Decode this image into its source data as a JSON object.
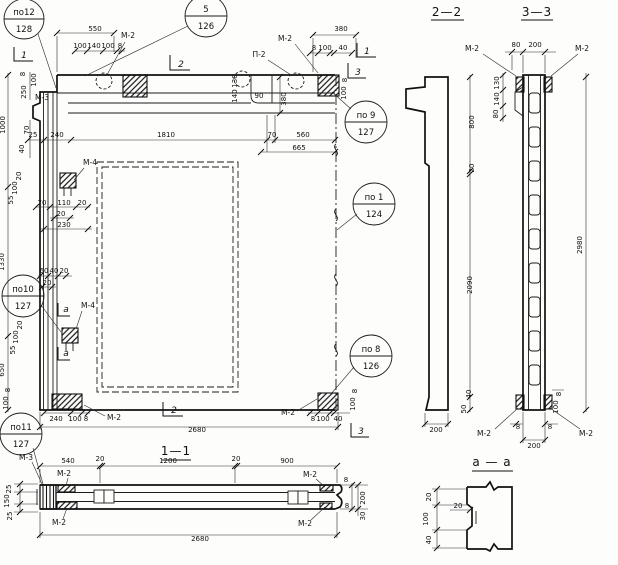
{
  "marks": {
    "m2": "М-2",
    "m3": "М-3",
    "m4": "М-4",
    "p2": "П-2"
  },
  "flags": {
    "s1": "1",
    "s2": "2",
    "s3": "3",
    "sa": "а"
  },
  "front": {
    "callouts": {
      "po12": {
        "pos": "по12",
        "sheet": "128"
      },
      "k5": {
        "pos": "5",
        "sheet": "126"
      },
      "po9": {
        "pos": "по 9",
        "sheet": "127"
      },
      "po1": {
        "pos": "по 1",
        "sheet": "124"
      },
      "po10": {
        "pos": "по10",
        "sheet": "127"
      },
      "po8": {
        "pos": "по 8",
        "sheet": "126"
      },
      "po11": {
        "pos": "по11",
        "sheet": "127"
      }
    },
    "dims": {
      "top": {
        "d550": "550",
        "sub": [
          "100",
          "140",
          "100",
          "8"
        ],
        "d380": "380",
        "sub_r": [
          "8",
          "100",
          "40"
        ]
      },
      "inner": {
        "chain": [
          "25",
          "240",
          "1810",
          "70",
          "560"
        ],
        "d665": "665",
        "notch": [
          "130",
          "140",
          "90",
          "380"
        ]
      },
      "left": {
        "heights": [
          "1000",
          "1330",
          "650"
        ],
        "corner": [
          "8",
          "100",
          "250"
        ],
        "steps": [
          "70",
          "40"
        ]
      },
      "right_corner": [
        "8",
        "100"
      ],
      "m4_upper": {
        "v": [
          "20",
          "100",
          "55"
        ],
        "h": [
          "70",
          "110",
          "20"
        ],
        "h2": "20",
        "h3": "230"
      },
      "mid": {
        "chain": [
          "60",
          "40",
          "20"
        ],
        "d20": "20"
      },
      "m4_lower": {
        "v": [
          "20",
          "100",
          "55"
        ]
      },
      "bottom_left": {
        "v": [
          "8",
          "100"
        ],
        "h": [
          "240",
          "100",
          "8"
        ]
      },
      "bottom": {
        "d2680": "2680"
      },
      "bottom_right": {
        "h": [
          "8",
          "100",
          "40"
        ],
        "v": [
          "8",
          "100"
        ]
      }
    }
  },
  "s22": {
    "title": "2—2",
    "v": [
      "800",
      "20",
      "2090",
      "40",
      "50"
    ],
    "w200": "200"
  },
  "s33": {
    "title": "3—3",
    "top": [
      "80",
      "200"
    ],
    "left": [
      "130",
      "140",
      "80"
    ],
    "h2980": "2980",
    "bottom": [
      "8",
      "8",
      "200"
    ],
    "right_v": [
      "8",
      "100"
    ]
  },
  "s11": {
    "title": "1—1",
    "top": [
      "540",
      "20",
      "1200",
      "20",
      "900"
    ],
    "left": [
      "25",
      "150",
      "25"
    ],
    "right": [
      "8",
      "200",
      "8",
      "30"
    ],
    "d2680": "2680"
  },
  "aa": {
    "title": "а — а",
    "v": [
      "20",
      "100",
      "40"
    ],
    "d20": "20"
  }
}
